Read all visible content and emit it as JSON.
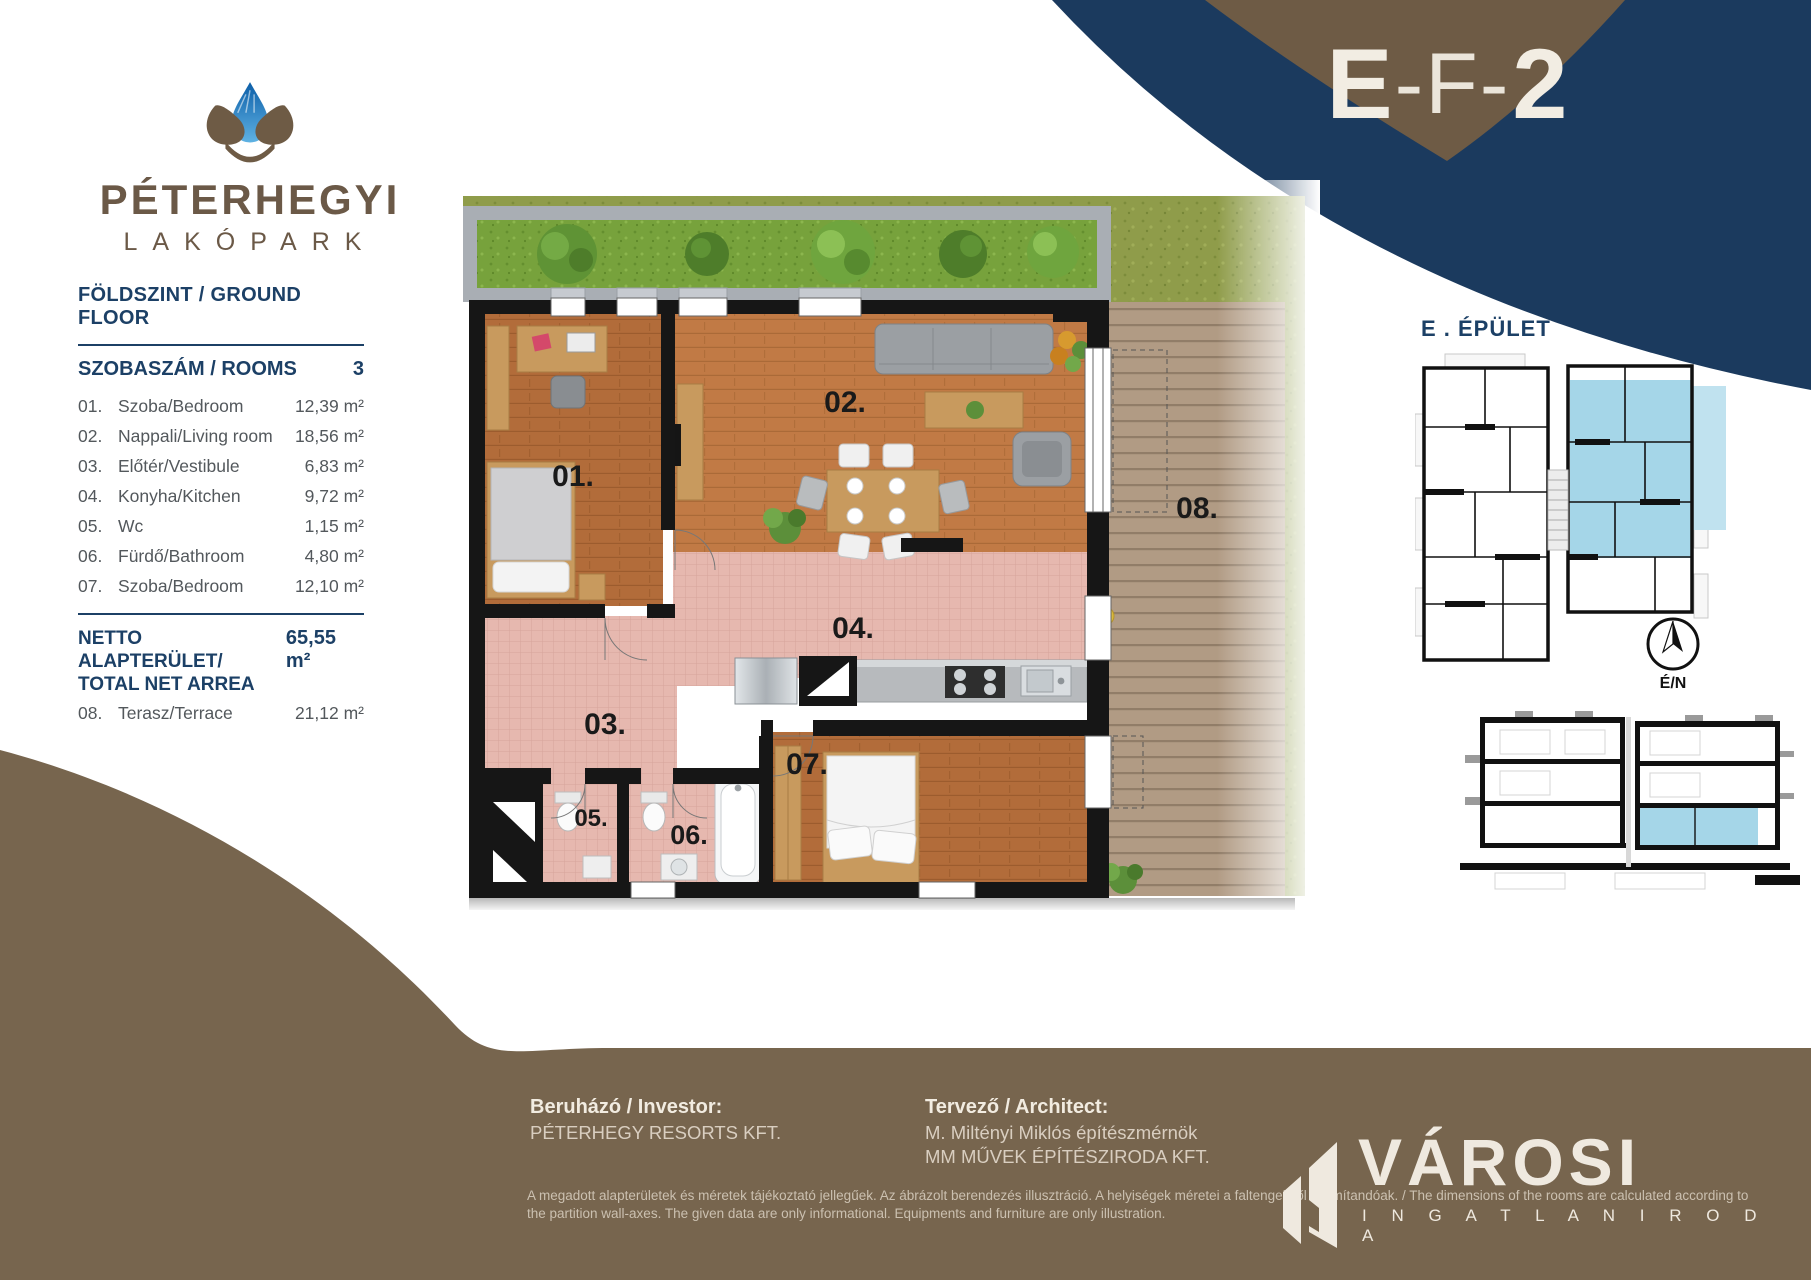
{
  "colors": {
    "navy": "#1b3a5e",
    "brown": "#77654e",
    "brown_dark": "#6e5b45",
    "cream": "#f2ede3",
    "highlight_blue": "#a5d6e8",
    "panel_navy": "#1c4066",
    "text_gray": "#53585c"
  },
  "header": {
    "logo_title": "PÉTERHEGYI",
    "logo_subtitle": "LAKÓPARK",
    "unit_code_part1": "E",
    "unit_code_part2": "-F-",
    "unit_code_part3": "2"
  },
  "panel": {
    "floor_label": "FÖLDSZINT / GROUND FLOOR",
    "rooms_header": {
      "label": "SZOBASZÁM / ROOMS",
      "count": "3"
    },
    "rooms": [
      {
        "num": "01.",
        "name": "Szoba/Bedroom",
        "area": "12,39 m²"
      },
      {
        "num": "02.",
        "name": "Nappali/Living room",
        "area": "18,56 m²"
      },
      {
        "num": "03.",
        "name": "Előtér/Vestibule",
        "area": "6,83 m²"
      },
      {
        "num": "04.",
        "name": "Konyha/Kitchen",
        "area": "9,72 m²"
      },
      {
        "num": "05.",
        "name": "Wc",
        "area": "1,15 m²"
      },
      {
        "num": "06.",
        "name": "Fürdő/Bathroom",
        "area": "4,80 m²"
      },
      {
        "num": "07.",
        "name": "Szoba/Bedroom",
        "area": "12,10 m²"
      }
    ],
    "total": {
      "label_line1": "NETTO ALAPTERÜLET/",
      "label_line2": "TOTAL NET ARREA",
      "value": "65,55 m²"
    },
    "terrace": {
      "num": "08.",
      "name": "Terasz/Terrace",
      "area": "21,12 m²"
    }
  },
  "plan": {
    "labels": {
      "r01": "01.",
      "r02": "02.",
      "r03": "03.",
      "r04": "04.",
      "r05": "05.",
      "r06": "06.",
      "r07": "07.",
      "r08": "08."
    }
  },
  "sidebar": {
    "building_label": "E . ÉPÜLET",
    "compass_label": "É/N"
  },
  "footer": {
    "investor": {
      "label": "Beruházó / Investor:",
      "name": "PÉTERHEGY RESORTS KFT."
    },
    "architect": {
      "label": "Tervező / Architect:",
      "line1": "M. Miltényi Miklós építészmérnök",
      "line2": "MM MŰVEK ÉPÍTÉSZIRODA KFT."
    },
    "disclaimer_line1": "A megadott alapterületek és méretek tájékoztató jellegűek. Az ábrázolt berendezés illusztráció. A helyiségek méretei a faltengelytől számítandóak. / The dimensions of the rooms are calculated according to",
    "disclaimer_line2": "the partition wall-axes. The given data are only informational. Equipments and furniture are only illustration.",
    "agency": {
      "name": "VÁROSI",
      "subtitle": "I N G A T L A N I R O D A"
    }
  }
}
